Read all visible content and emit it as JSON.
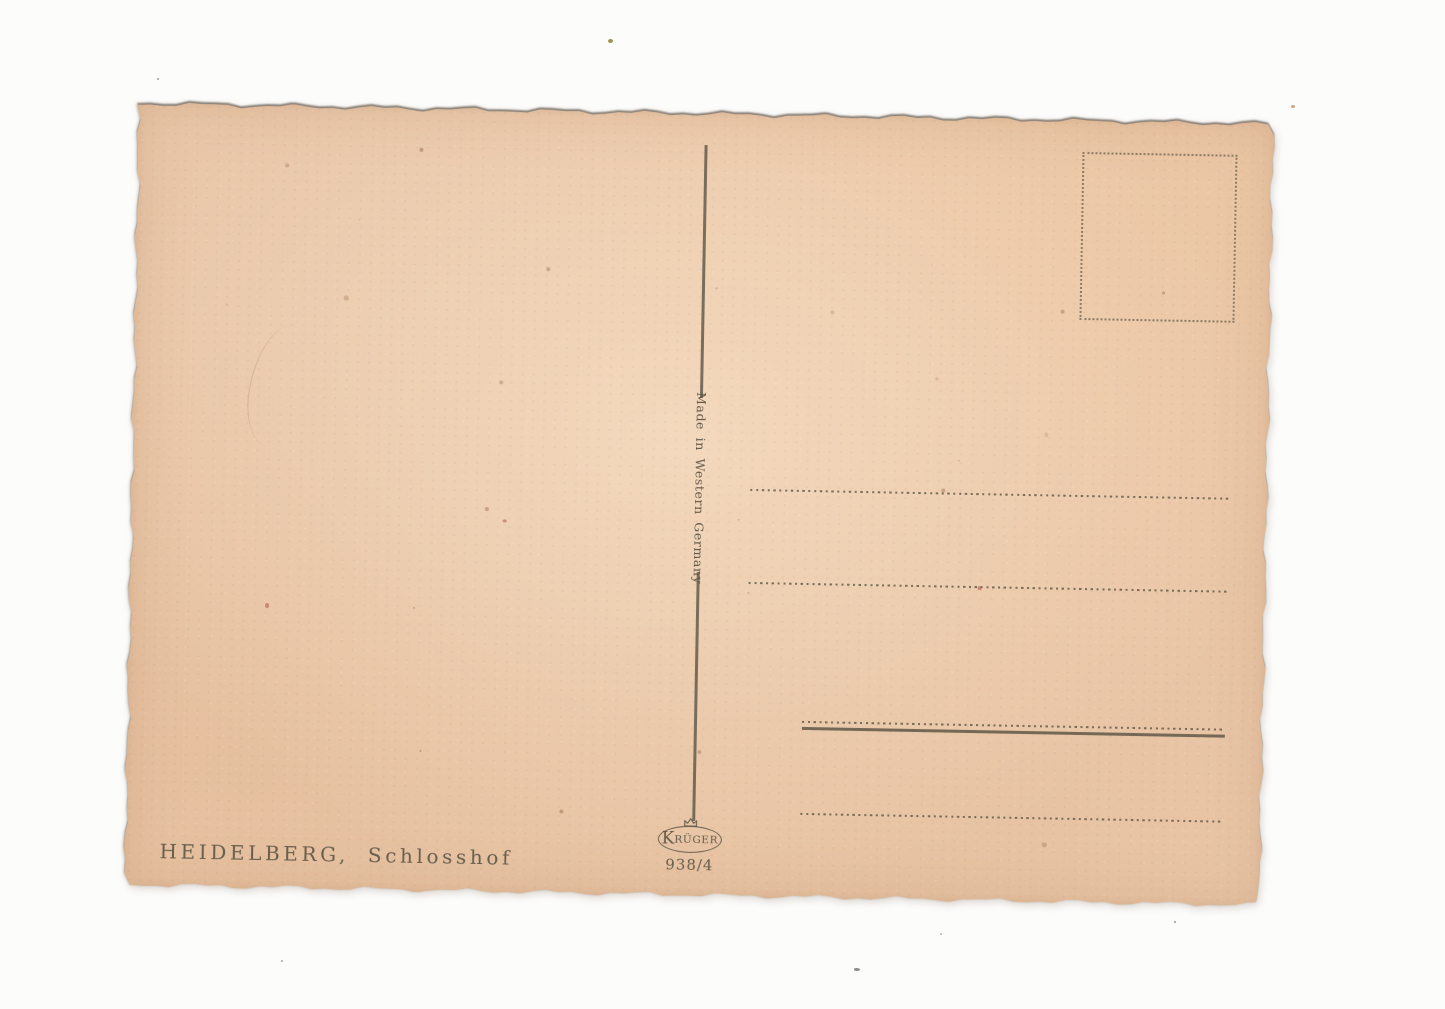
{
  "postcard": {
    "caption": "HEIDELBERG, Schlosshof",
    "divider_text": "Made in Western Germany",
    "publisher": {
      "logo_initial": "K",
      "logo_rest": "RÜGER",
      "catalog_number": "938/4"
    },
    "colors": {
      "paper": "#e9c7a9",
      "ink": "#5f584a",
      "line": "#6e6758",
      "background": "#fcfcfb"
    }
  }
}
